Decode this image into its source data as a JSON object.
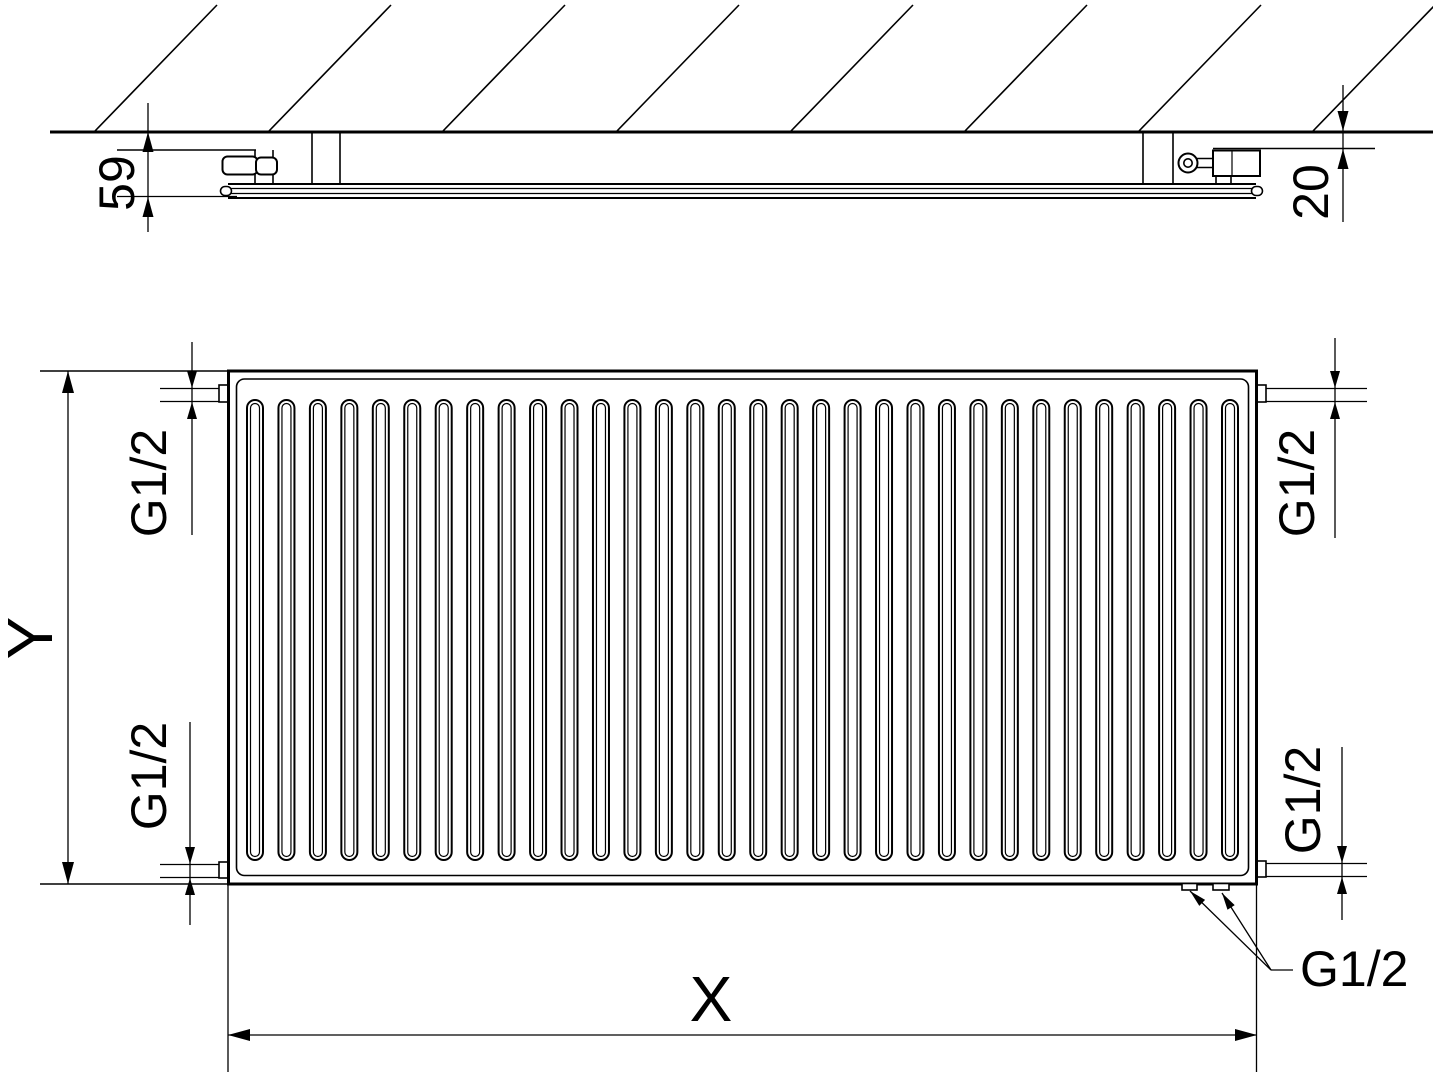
{
  "labels": {
    "depth": "59",
    "wall_clearance": "20",
    "thread_top_left": "G1/2",
    "thread_top_right": "G1/2",
    "thread_bottom_left": "G1/2",
    "thread_bottom_right": "G1/2",
    "thread_bottom_center": "G1/2",
    "width": "X",
    "height": "Y"
  },
  "drawing": {
    "background": "#ffffff",
    "line_color": "#000000",
    "hatch": {
      "count": 8,
      "start_x": 95,
      "spacing_x": 174,
      "rise_dx": 122,
      "wall_y": 131,
      "top_y": 5
    },
    "channels": {
      "count": 32,
      "span_left": 247,
      "span_right": 1238,
      "width": 16,
      "top": 400,
      "bottom": 860,
      "inner_inset": 3.5
    }
  }
}
